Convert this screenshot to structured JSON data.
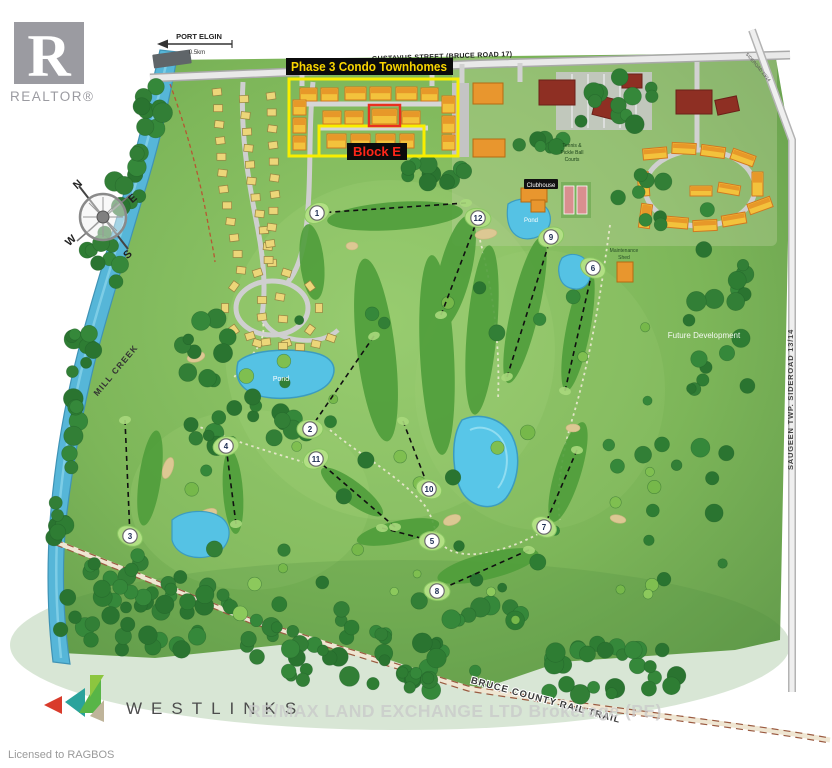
{
  "branding": {
    "realtor_logo_letter": "R",
    "realtor_wordmark": "REALTOR®",
    "westlinks_wordmark": "WESTLINKS",
    "licensed_to": "Licensed to RAGBOS",
    "watermark": "RE/MAX LAND EXCHANGE LTD Brokerage (PE)"
  },
  "annotations": {
    "phase3_label": "Phase 3 Condo Townhomes",
    "block_e_label": "Block E",
    "highlight_yellow": "#f8ee00",
    "highlight_red": "#e8301f"
  },
  "navigation": {
    "port_elgin": "PORT ELGIN",
    "port_elgin_distance": "0.5km",
    "top_street": "GUSTAVUS STREET (BRUCE ROAD 17)",
    "east_road": "SAUGEEN TWP. SIDEROAD 13/14",
    "east_road_top": "SIDEROAD 13/14",
    "rail_trail": "BRUCE COUNTY RAIL TRAIL",
    "creek": "MILL CREEK"
  },
  "site_labels": {
    "future_development": "Future Development",
    "clubhouse": "Clubhouse",
    "tennis_line1": "Tennis &",
    "tennis_line2": "Pickle Ball",
    "tennis_line3": "Courts",
    "maintenance_line1": "Maintenance",
    "maintenance_line2": "Shed",
    "pond_west": "Pond",
    "pond_north": "Pond"
  },
  "compass": {
    "north": "N",
    "east": "E",
    "south": "S",
    "west": "W"
  },
  "golf_holes": [
    {
      "number": "1",
      "x": 317,
      "y": 213,
      "x2": 466,
      "y2": 203
    },
    {
      "number": "2",
      "x": 310,
      "y": 429,
      "x2": 374,
      "y2": 336
    },
    {
      "number": "3",
      "x": 130,
      "y": 536,
      "x2": 125,
      "y2": 420
    },
    {
      "number": "4",
      "x": 226,
      "y": 446,
      "x2": 236,
      "y2": 524
    },
    {
      "number": "5",
      "x": 432,
      "y": 541,
      "x2": 382,
      "y2": 528
    },
    {
      "number": "6",
      "x": 593,
      "y": 268,
      "x2": 565,
      "y2": 391
    },
    {
      "number": "7",
      "x": 544,
      "y": 527,
      "x2": 577,
      "y2": 450
    },
    {
      "number": "8",
      "x": 437,
      "y": 591,
      "x2": 529,
      "y2": 550
    },
    {
      "number": "9",
      "x": 551,
      "y": 237,
      "x2": 507,
      "y2": 377
    },
    {
      "number": "10",
      "x": 429,
      "y": 489,
      "x2": 403,
      "y2": 421
    },
    {
      "number": "11",
      "x": 316,
      "y": 459,
      "x2": 395,
      "y2": 527
    },
    {
      "number": "12",
      "x": 478,
      "y": 218,
      "x2": 441,
      "y2": 315
    }
  ]
}
